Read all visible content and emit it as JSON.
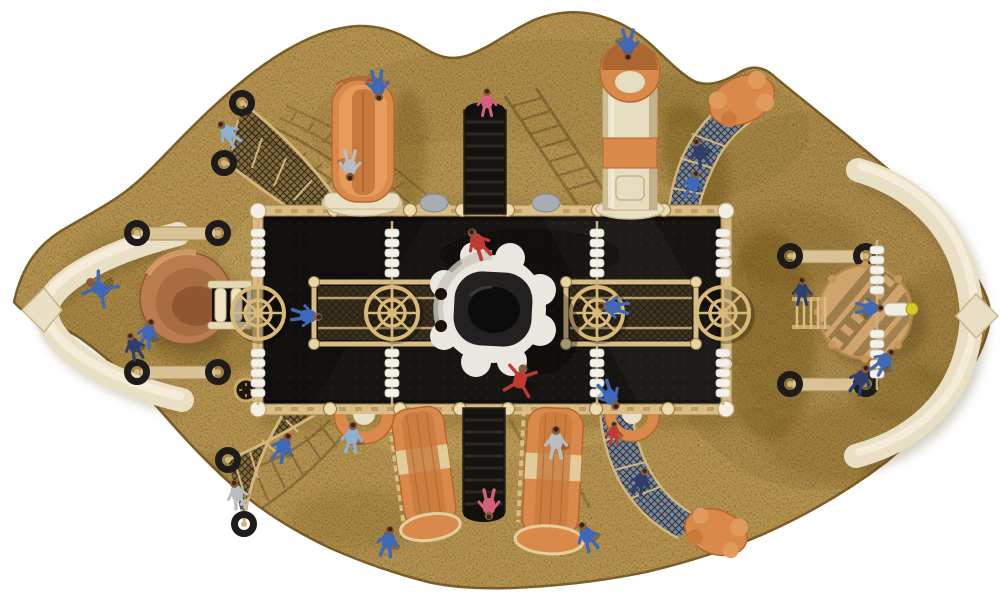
{
  "scene": {
    "title": "Top-down 3D render of a pirate-ship themed playground on a sand play area",
    "view": "top-down",
    "background": "#ffffff"
  },
  "palette": {
    "background": "#ffffff",
    "sand": "#b3914f",
    "sand_light": "#c6a55f",
    "sand_edge": "#7c5f28",
    "sand_shadow": "#55400f",
    "deck": "#171512",
    "deck_dot": "#2b2924",
    "frame": "#d9bd85",
    "frame_dark": "#9a7c46",
    "cream": "#e9dfc4",
    "cream_shade": "#c9b88e",
    "orange": "#d98a4a",
    "orange_dark": "#b5672f",
    "terracotta": "#b97c4e",
    "mast": "#f3f1e9",
    "net_dark": "#2e2a1f",
    "net_blue": "#7387a6",
    "tire": "#1d1c1a",
    "wheel": "#d8b977",
    "dome_white": "#e9e7df",
    "dome_black": "#0c0c0c",
    "roof_gray": "#a8adb3",
    "telescope_yellow": "#d8c829",
    "skin": "#8a5a3a",
    "kid_blue": "#3f68b8",
    "kid_lightblue": "#8fb0cf",
    "kid_navy": "#2e3f6e",
    "kid_red": "#c03a32",
    "kid_pink": "#d4607a",
    "kid_gray": "#b7bdc0"
  },
  "components": [
    "sand-play-area",
    "main-deck",
    "perimeter-railing",
    "bow-structure-left",
    "bow-structure-right",
    "spinner-bowl",
    "rope-bridge",
    "double-wave-slide",
    "tube-slide-tower",
    "climbing-stairs-north",
    "climbing-stairs-south",
    "wave-slide-southwest",
    "wave-slide-south",
    "crawl-arch-left",
    "crawl-arch-right",
    "net-climber-northwest",
    "net-climber-southwest",
    "net-tube-northeast",
    "net-tube-southeast",
    "rock-anchors",
    "ship-helm-wheels",
    "sail-masts",
    "crows-nest-platform",
    "telescope",
    "porthole-clock",
    "balance-log-beams",
    "tire-anchors",
    "roof-domes",
    "space-dome"
  ],
  "figures": [
    {
      "x": 100,
      "y": 289,
      "rot": -55,
      "s": 1.05,
      "color": "kid_blue",
      "pose": "spread"
    },
    {
      "x": 148,
      "y": 333,
      "rot": 15,
      "s": 0.95,
      "color": "kid_blue",
      "pose": "stand"
    },
    {
      "x": 134,
      "y": 346,
      "rot": -20,
      "s": 0.9,
      "color": "kid_navy",
      "pose": "stand"
    },
    {
      "x": 228,
      "y": 133,
      "rot": -40,
      "s": 0.95,
      "color": "kid_lightblue",
      "pose": "stand"
    },
    {
      "x": 283,
      "y": 447,
      "rot": 25,
      "s": 1,
      "color": "kid_blue",
      "pose": "stand"
    },
    {
      "x": 237,
      "y": 494,
      "rot": -15,
      "s": 0.95,
      "color": "kid_gray",
      "pose": "stand"
    },
    {
      "x": 352,
      "y": 437,
      "rot": 5,
      "s": 1,
      "color": "kid_lightblue",
      "pose": "stand"
    },
    {
      "x": 388,
      "y": 541,
      "rot": 10,
      "s": 1,
      "color": "kid_blue",
      "pose": "stand"
    },
    {
      "x": 556,
      "y": 442,
      "rot": 0,
      "s": 1.05,
      "color": "kid_gray",
      "pose": "stand"
    },
    {
      "x": 587,
      "y": 536,
      "rot": -25,
      "s": 1,
      "color": "kid_blue",
      "pose": "stand"
    },
    {
      "x": 861,
      "y": 379,
      "rot": 25,
      "s": 1,
      "color": "kid_navy",
      "pose": "stand"
    },
    {
      "x": 884,
      "y": 361,
      "rot": 40,
      "s": 0.95,
      "color": "kid_blue",
      "pose": "stand"
    },
    {
      "x": 802,
      "y": 291,
      "rot": 0,
      "s": 0.9,
      "color": "kid_navy",
      "pose": "stand"
    },
    {
      "x": 870,
      "y": 308,
      "rot": 90,
      "s": 0.9,
      "color": "kid_blue",
      "pose": "stand"
    },
    {
      "x": 700,
      "y": 152,
      "rot": -20,
      "s": 0.9,
      "color": "kid_navy",
      "pose": "stand"
    },
    {
      "x": 693,
      "y": 184,
      "rot": 15,
      "s": 0.9,
      "color": "kid_blue",
      "pose": "stand"
    },
    {
      "x": 614,
      "y": 433,
      "rot": 0,
      "s": 0.75,
      "color": "kid_red",
      "pose": "stand"
    },
    {
      "x": 641,
      "y": 481,
      "rot": 20,
      "s": 0.9,
      "color": "kid_navy",
      "pose": "stand"
    },
    {
      "x": 628,
      "y": 45,
      "rot": 180,
      "s": 1,
      "color": "kid_blue",
      "pose": "stand"
    },
    {
      "x": 378,
      "y": 86,
      "rot": 175,
      "s": 1,
      "color": "kid_blue",
      "pose": "stand"
    },
    {
      "x": 350,
      "y": 166,
      "rot": 180,
      "s": 1,
      "color": "kid_gray",
      "pose": "stand"
    },
    {
      "x": 487,
      "y": 102,
      "rot": 0,
      "s": 0.9,
      "color": "kid_pink",
      "pose": "stand"
    },
    {
      "x": 489,
      "y": 505,
      "rot": 180,
      "s": 1,
      "color": "kid_pink",
      "pose": "stand"
    },
    {
      "x": 478,
      "y": 243,
      "rot": -30,
      "s": 1.05,
      "color": "kid_red",
      "pose": "stand"
    },
    {
      "x": 520,
      "y": 380,
      "rot": 15,
      "s": 1.05,
      "color": "kid_red",
      "pose": "spread"
    },
    {
      "x": 307,
      "y": 316,
      "rot": 95,
      "s": 1,
      "color": "kid_blue",
      "pose": "stand"
    },
    {
      "x": 613,
      "y": 307,
      "rot": -85,
      "s": 1,
      "color": "kid_blue",
      "pose": "stand"
    },
    {
      "x": 610,
      "y": 396,
      "rot": 150,
      "s": 1,
      "color": "kid_blue",
      "pose": "stand"
    }
  ]
}
